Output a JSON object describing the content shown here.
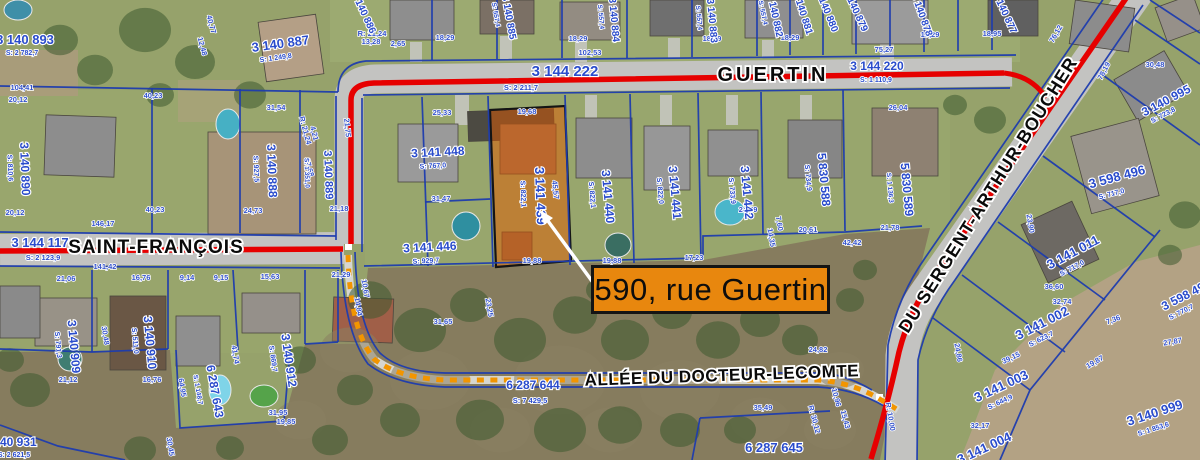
{
  "callout": {
    "text": "590, rue Guertin"
  },
  "highlight_parcel": {
    "id": "3 141 439",
    "x": 536,
    "y": 196,
    "r": 88,
    "s": 13,
    "area": "S: 822,1",
    "ax": 521,
    "ay": 194
  },
  "streets": [
    {
      "name": "GUERTIN",
      "x": 773,
      "y": 81,
      "r": 0,
      "s": 20,
      "ls": 3
    },
    {
      "name": "SAINT-FRANÇOIS",
      "x": 156,
      "y": 253,
      "r": 0,
      "s": 19,
      "ls": 1
    },
    {
      "name": "DU SERGENT-ARTHUR-BOUCHER",
      "x": 993,
      "y": 198,
      "r": -58,
      "s": 18,
      "ls": 1
    },
    {
      "name": "ALLÉE DU DOCTEUR-LECOMTE",
      "x": 722,
      "y": 381,
      "r": -2,
      "s": 17,
      "ls": 0.5
    }
  ],
  "parcels": [
    {
      "id": "3 144 222",
      "x": 565,
      "y": 76,
      "r": 0,
      "s": 15,
      "area": "S: 2 211,7",
      "ax": 521,
      "ay": 90,
      "as": 7.5
    },
    {
      "id": "3 144 220",
      "x": 877,
      "y": 70,
      "r": 0,
      "s": 12,
      "area": "S: 1 110,9",
      "ax": 876,
      "ay": 82
    },
    {
      "id": "3 144 117",
      "x": 40,
      "y": 247,
      "r": 0,
      "s": 13,
      "area": "S: 2 123,9",
      "ax": 43,
      "ay": 260,
      "as": 7.5
    },
    {
      "id": "6 287 644",
      "x": 533,
      "y": 389,
      "r": 0,
      "s": 12,
      "area": "S: 7 429,5",
      "ax": 530,
      "ay": 403,
      "as": 7.5
    },
    {
      "id": "6 287 645",
      "x": 774,
      "y": 452,
      "r": 0,
      "s": 13
    },
    {
      "id": "3 140 893",
      "x": 25,
      "y": 44,
      "r": 0,
      "s": 13,
      "area": "S: 2 782,7",
      "ax": 22,
      "ay": 55
    },
    {
      "id": "3 140 887",
      "x": 281,
      "y": 48,
      "r": -8,
      "s": 13,
      "area": "S: 1 249,8",
      "ax": 276,
      "ay": 60
    },
    {
      "id": "3 140 886",
      "x": 361,
      "y": 14,
      "r": 65,
      "s": 10
    },
    {
      "id": "3 140 885",
      "x": 506,
      "y": 18,
      "r": 80,
      "s": 10,
      "area": "S: 557,4",
      "ax": 494,
      "ay": 15,
      "as": 6.5
    },
    {
      "id": "3 140 884",
      "x": 611,
      "y": 20,
      "r": 85,
      "s": 10,
      "area": "S: 557,4",
      "ax": 599,
      "ay": 17,
      "as": 6.5
    },
    {
      "id": "3 140 883",
      "x": 709,
      "y": 21,
      "r": 85,
      "s": 10,
      "area": "S: 557,4",
      "ax": 697,
      "ay": 18,
      "as": 6.5
    },
    {
      "id": "3 140 882",
      "x": 772,
      "y": 16,
      "r": 78,
      "s": 10,
      "area": "S: 557,4",
      "ax": 761,
      "ay": 13,
      "as": 6.5
    },
    {
      "id": "3 140 881",
      "x": 800,
      "y": 14,
      "r": 72,
      "s": 10
    },
    {
      "id": "3 140 880",
      "x": 824,
      "y": 12,
      "r": 68,
      "s": 10
    },
    {
      "id": "3 140 879",
      "x": 853,
      "y": 12,
      "r": 65,
      "s": 10
    },
    {
      "id": "3 140 878",
      "x": 919,
      "y": 16,
      "r": 70,
      "s": 10
    },
    {
      "id": "3 140 877",
      "x": 1002,
      "y": 14,
      "r": 65,
      "s": 10
    },
    {
      "id": "3 140 890",
      "x": 21,
      "y": 169,
      "r": 88,
      "s": 12,
      "area": "S: 810,6",
      "ax": 8,
      "ay": 168
    },
    {
      "id": "3 140 888",
      "x": 268,
      "y": 171,
      "r": 88,
      "s": 12,
      "area": "S: 927,5",
      "ax": 254,
      "ay": 169
    },
    {
      "id": "3 140 889",
      "x": 325,
      "y": 175,
      "r": 88,
      "s": 11,
      "area": "S: 1 351,0",
      "ax": 305,
      "ay": 173,
      "as": 6.5
    },
    {
      "id": "3 141 448",
      "x": 438,
      "y": 156,
      "r": -3,
      "s": 12,
      "area": "S: 767,0",
      "ax": 433,
      "ay": 168
    },
    {
      "id": "3 141 446",
      "x": 430,
      "y": 251,
      "r": -3,
      "s": 12,
      "area": "S: 929,7",
      "ax": 426,
      "ay": 263
    },
    {
      "id": "3 141 440",
      "x": 604,
      "y": 197,
      "r": 85,
      "s": 12,
      "area": "S: 822,1",
      "ax": 590,
      "ay": 195
    },
    {
      "id": "3 141 441",
      "x": 671,
      "y": 193,
      "r": 85,
      "s": 12,
      "area": "S: 822,0",
      "ax": 658,
      "ay": 191
    },
    {
      "id": "3 141 442",
      "x": 743,
      "y": 193,
      "r": 85,
      "s": 12,
      "area": "S: 733,9",
      "ax": 730,
      "ay": 191
    },
    {
      "id": "5 830 588",
      "x": 820,
      "y": 180,
      "r": 85,
      "s": 12,
      "area": "S: 734,9",
      "ax": 806,
      "ay": 178
    },
    {
      "id": "5 830 589",
      "x": 903,
      "y": 190,
      "r": 85,
      "s": 12,
      "area": "S: 1 136,3",
      "ax": 888,
      "ay": 188,
      "as": 6.5
    },
    {
      "id": "3 140 909",
      "x": 70,
      "y": 347,
      "r": 85,
      "s": 12,
      "area": "S: 791,3",
      "ax": 56,
      "ay": 345
    },
    {
      "id": "3 140 910",
      "x": 146,
      "y": 343,
      "r": 85,
      "s": 12,
      "area": "S: 511,0",
      "ax": 133,
      "ay": 341
    },
    {
      "id": "6 287 643",
      "x": 211,
      "y": 392,
      "r": 80,
      "s": 12,
      "area": "S: 1 148,7",
      "ax": 196,
      "ay": 390,
      "as": 6.5
    },
    {
      "id": "3 140 912",
      "x": 285,
      "y": 361,
      "r": 82,
      "s": 12,
      "area": "S: 869,7",
      "ax": 271,
      "ay": 359
    },
    {
      "id": "3 140 931",
      "x": 10,
      "y": 446,
      "r": 0,
      "s": 12,
      "area": "S: 2 621,5",
      "ax": 14,
      "ay": 457
    },
    {
      "id": "3 140 995",
      "x": 1168,
      "y": 104,
      "r": -28,
      "s": 12,
      "area": "S: 723,8",
      "ax": 1164,
      "ay": 117
    },
    {
      "id": "3 598 496",
      "x": 1118,
      "y": 181,
      "r": -15,
      "s": 13,
      "area": "S: 717,0",
      "ax": 1112,
      "ay": 196
    },
    {
      "id": "3 141 011",
      "x": 1075,
      "y": 256,
      "r": -28,
      "s": 13,
      "area": "S: 717,0",
      "ax": 1073,
      "ay": 270
    },
    {
      "id": "3 141 002",
      "x": 1044,
      "y": 327,
      "r": -27,
      "s": 13,
      "area": "S: 623,7",
      "ax": 1042,
      "ay": 341
    },
    {
      "id": "3 141 003",
      "x": 1003,
      "y": 390,
      "r": -25,
      "s": 13,
      "area": "S: 644,9",
      "ax": 1001,
      "ay": 404
    },
    {
      "id": "3 141 004",
      "x": 986,
      "y": 452,
      "r": -25,
      "s": 13
    },
    {
      "id": "3 140 999",
      "x": 1156,
      "y": 417,
      "r": -18,
      "s": 13,
      "area": "S: 1 853,6",
      "ax": 1154,
      "ay": 431
    },
    {
      "id": "3 598 49",
      "x": 1185,
      "y": 300,
      "r": -27,
      "s": 12,
      "area": "S: 770,7",
      "ax": 1182,
      "ay": 314
    }
  ],
  "measurements": [
    {
      "t": "104,41",
      "x": 22,
      "y": 90
    },
    {
      "t": "20,12",
      "x": 18,
      "y": 102
    },
    {
      "t": "40,23",
      "x": 153,
      "y": 98
    },
    {
      "t": "40,77",
      "x": 209,
      "y": 25,
      "r": 75
    },
    {
      "t": "12,48",
      "x": 200,
      "y": 47,
      "r": 75
    },
    {
      "t": "31,54",
      "x": 276,
      "y": 110
    },
    {
      "t": "R: 21,24",
      "x": 303,
      "y": 131,
      "r": 75
    },
    {
      "t": "4,21",
      "x": 312,
      "y": 134,
      "r": 75
    },
    {
      "t": "17,68",
      "x": 307,
      "y": 168,
      "r": 75
    },
    {
      "t": "24,73",
      "x": 253,
      "y": 213
    },
    {
      "t": "40,23",
      "x": 155,
      "y": 212
    },
    {
      "t": "146,17",
      "x": 103,
      "y": 226
    },
    {
      "t": "21,18",
      "x": 339,
      "y": 211
    },
    {
      "t": "20,12",
      "x": 15,
      "y": 215
    },
    {
      "t": "R: 21,24",
      "x": 372,
      "y": 36
    },
    {
      "t": "13,28",
      "x": 371,
      "y": 44
    },
    {
      "t": "2,65",
      "x": 398,
      "y": 46
    },
    {
      "t": "18,29",
      "x": 445,
      "y": 40
    },
    {
      "t": "18,29",
      "x": 578,
      "y": 41
    },
    {
      "t": "18,29",
      "x": 712,
      "y": 41
    },
    {
      "t": "18,29",
      "x": 790,
      "y": 40
    },
    {
      "t": "18,29",
      "x": 930,
      "y": 37
    },
    {
      "t": "18,95",
      "x": 992,
      "y": 36
    },
    {
      "t": "102,53",
      "x": 590,
      "y": 55
    },
    {
      "t": "75,27",
      "x": 884,
      "y": 52
    },
    {
      "t": "76,12",
      "x": 1058,
      "y": 35,
      "r": -60
    },
    {
      "t": "78,19",
      "x": 1106,
      "y": 72,
      "r": -62
    },
    {
      "t": "30,48",
      "x": 1155,
      "y": 67
    },
    {
      "t": "141,42",
      "x": 105,
      "y": 269
    },
    {
      "t": "16,76",
      "x": 141,
      "y": 280
    },
    {
      "t": "9,14",
      "x": 187,
      "y": 280
    },
    {
      "t": "9,15",
      "x": 221,
      "y": 280
    },
    {
      "t": "21,06",
      "x": 66,
      "y": 281
    },
    {
      "t": "15,63",
      "x": 270,
      "y": 279
    },
    {
      "t": "21,29",
      "x": 341,
      "y": 277
    },
    {
      "t": "10,67",
      "x": 363,
      "y": 289,
      "r": 80
    },
    {
      "t": "14,84",
      "x": 356,
      "y": 307,
      "r": 80
    },
    {
      "t": "21,75",
      "x": 345,
      "y": 128,
      "r": 85
    },
    {
      "t": "31,47",
      "x": 441,
      "y": 201
    },
    {
      "t": "25,33",
      "x": 442,
      "y": 115
    },
    {
      "t": "19,68",
      "x": 527,
      "y": 114
    },
    {
      "t": "19,88",
      "x": 532,
      "y": 263
    },
    {
      "t": "19,88",
      "x": 612,
      "y": 263
    },
    {
      "t": "17,23",
      "x": 694,
      "y": 260
    },
    {
      "t": "45,57",
      "x": 553,
      "y": 190,
      "r": 85
    },
    {
      "t": "31,65",
      "x": 443,
      "y": 324
    },
    {
      "t": "23,25",
      "x": 487,
      "y": 308,
      "r": 80
    },
    {
      "t": "24,79",
      "x": 748,
      "y": 212
    },
    {
      "t": "35,49",
      "x": 763,
      "y": 410
    },
    {
      "t": "24,82",
      "x": 818,
      "y": 352
    },
    {
      "t": "21,12",
      "x": 68,
      "y": 382
    },
    {
      "t": "16,76",
      "x": 152,
      "y": 382
    },
    {
      "t": "41,74",
      "x": 233,
      "y": 355,
      "r": 80
    },
    {
      "t": "64,95",
      "x": 180,
      "y": 388,
      "r": 80
    },
    {
      "t": "30,45",
      "x": 168,
      "y": 447,
      "r": 80
    },
    {
      "t": "30,48",
      "x": 103,
      "y": 336,
      "r": 80
    },
    {
      "t": "31,95",
      "x": 278,
      "y": 415
    },
    {
      "t": "19,85",
      "x": 286,
      "y": 424
    },
    {
      "t": "42,42",
      "x": 852,
      "y": 245
    },
    {
      "t": "20,61",
      "x": 808,
      "y": 232
    },
    {
      "t": "7,60",
      "x": 777,
      "y": 224,
      "r": 80
    },
    {
      "t": "14,35",
      "x": 769,
      "y": 238,
      "r": 80
    },
    {
      "t": "21,78",
      "x": 890,
      "y": 230
    },
    {
      "t": "26,04",
      "x": 898,
      "y": 110
    },
    {
      "t": "23,90",
      "x": 1028,
      "y": 224,
      "r": 80
    },
    {
      "t": "36,60",
      "x": 1054,
      "y": 289
    },
    {
      "t": "32,74",
      "x": 1062,
      "y": 304
    },
    {
      "t": "7,36",
      "x": 1114,
      "y": 322,
      "r": -20
    },
    {
      "t": "19,87",
      "x": 1096,
      "y": 364,
      "r": -30
    },
    {
      "t": "27,87",
      "x": 1173,
      "y": 344,
      "r": -10
    },
    {
      "t": "15,43",
      "x": 843,
      "y": 420,
      "r": 75
    },
    {
      "t": "R: 30,12",
      "x": 812,
      "y": 420,
      "r": 75
    },
    {
      "t": "10,96",
      "x": 834,
      "y": 398,
      "r": 75
    },
    {
      "t": "R: 10,00",
      "x": 888,
      "y": 417,
      "r": 80
    },
    {
      "t": "24,86",
      "x": 956,
      "y": 353,
      "r": 80
    },
    {
      "t": "32,17",
      "x": 980,
      "y": 428
    },
    {
      "t": "39,15",
      "x": 1012,
      "y": 360,
      "r": -25
    }
  ],
  "colors": {
    "cadastral_text": "#2a4ccc",
    "boundary_line": "#1e3cae",
    "road_centerline": "#e60000",
    "path_dash": "#f29500",
    "highlight_fill": "#e05a00",
    "callout_bg": "#e8870e",
    "callout_border": "#141414"
  }
}
